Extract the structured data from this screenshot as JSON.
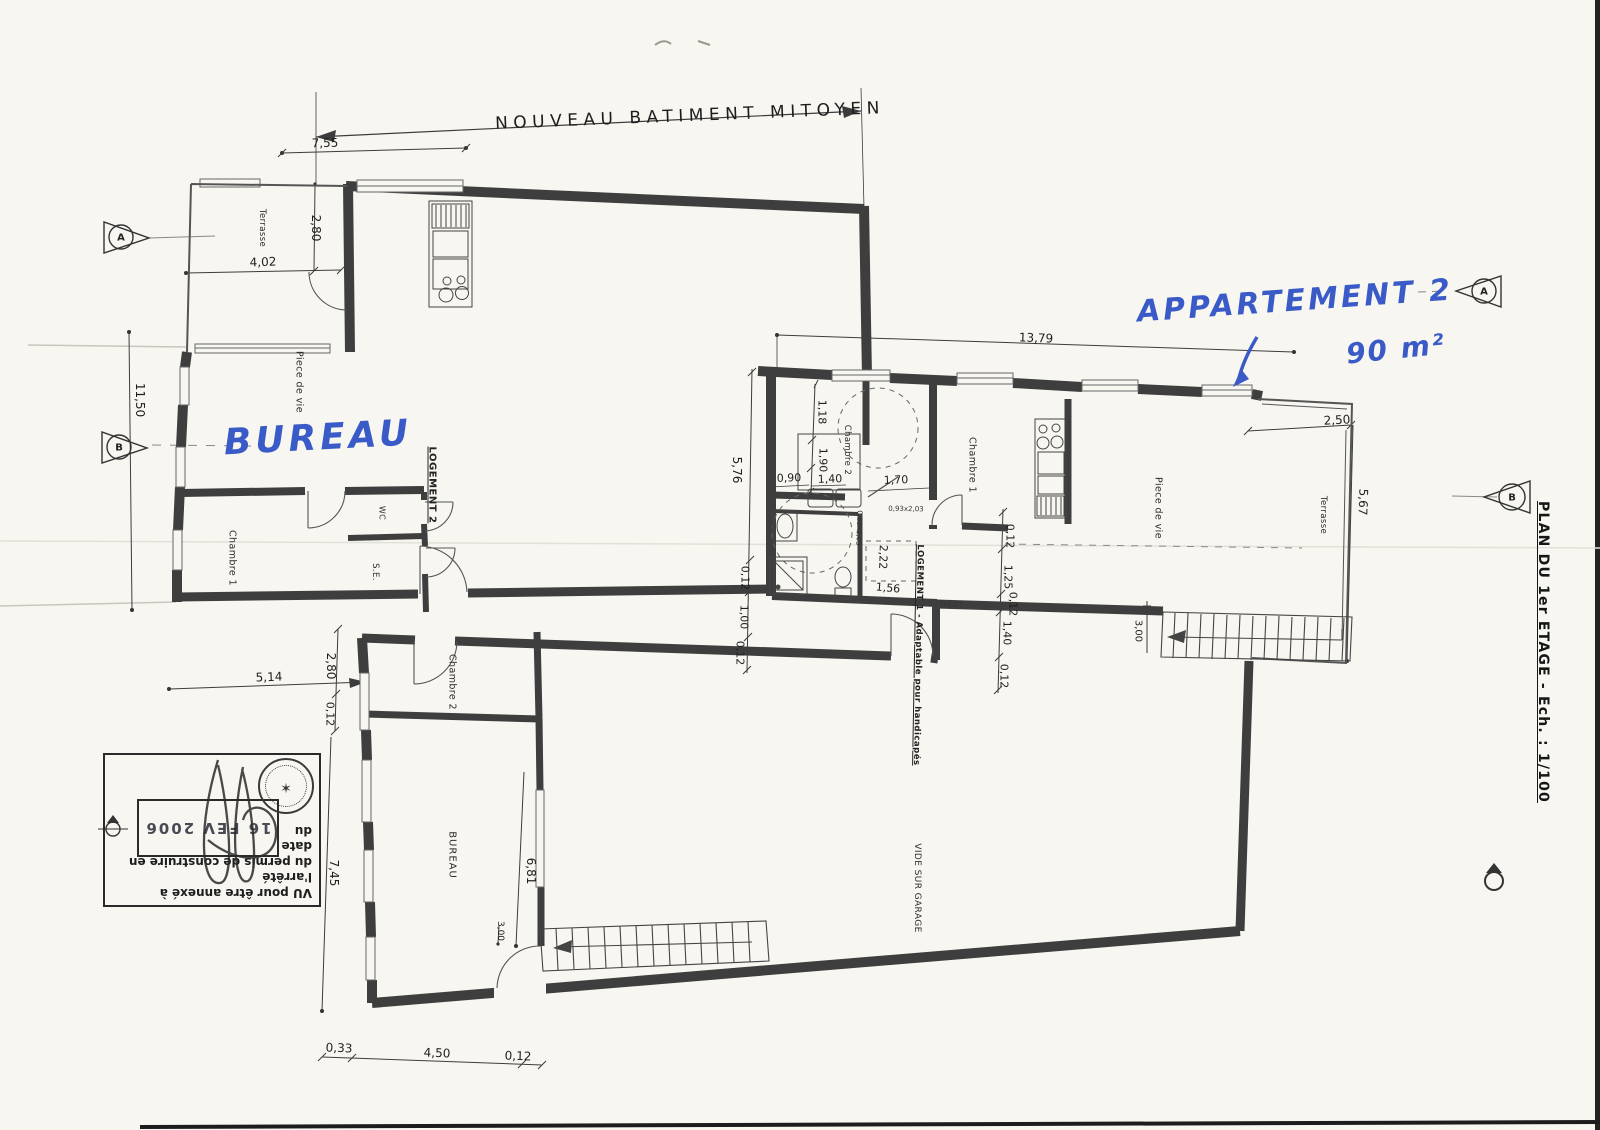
{
  "plan": {
    "top_label": "NOUVEAU BATIMENT MITOYEN",
    "side_title": "PLAN DU 1er ETAGE  -  Ech. : 1/100",
    "handwriting": {
      "office": "BUREAU",
      "apartment_name": "APPARTEMENT 2",
      "apartment_area": "90 m²"
    },
    "rooms": {
      "terrace_left": "Terrasse",
      "living_left": "Piece de vie",
      "bedroom1_left": "Chambre 1",
      "wc": "WC",
      "shower_room": "S.E.",
      "unit2": "LOGEMENT 2",
      "bedroom2_center": "Chambre 2",
      "bedroom1_right": "Chambre 1",
      "living_right": "Piece de vie",
      "terrace_right": "Terrasse",
      "unit1": "LOGEMENT 1 - Adaptable pour handicapés",
      "bedroom2_bottom": "Chambre 2",
      "office_room": "BUREAU",
      "void_over_garage": "VIDE SUR GARAGE"
    },
    "dims": {
      "w755": "7,55",
      "w280t": "2,80",
      "w402": "4,02",
      "w1150": "11,50",
      "w1379": "13,79",
      "w250": "2,50",
      "w567": "5,67",
      "w576": "5,76",
      "w118": "1,18",
      "w190": "1,90",
      "w140a": "1,40",
      "w090": "0,90",
      "w170": "1,70",
      "w012a": "0,12",
      "w100": "1,00",
      "w012b": "0,12",
      "w222": "2,22",
      "w156": "1,56",
      "w012c": "0,12",
      "w125": "1,25",
      "w012d": "0,12",
      "w140b": "1,40",
      "w012e": "0,12",
      "w300r": "3,00",
      "w514": "5,14",
      "w280b": "2,80",
      "w012f": "0,12",
      "w745": "7,45",
      "w681": "6,81",
      "w300b": "3,00",
      "w033": "0,33",
      "w450": "4,50",
      "w012g": "0,12"
    },
    "doors": {
      "a": "0,93x2,03",
      "b": "0,83x2,03",
      "c": "3x2,03"
    },
    "markers": {
      "a": "A",
      "b": "B"
    },
    "stamp": {
      "line1": "VU pour être annexé à l'arrêté",
      "line2": "du permis de construire en date",
      "line3": "du",
      "date": "16 FEV 2006"
    }
  }
}
